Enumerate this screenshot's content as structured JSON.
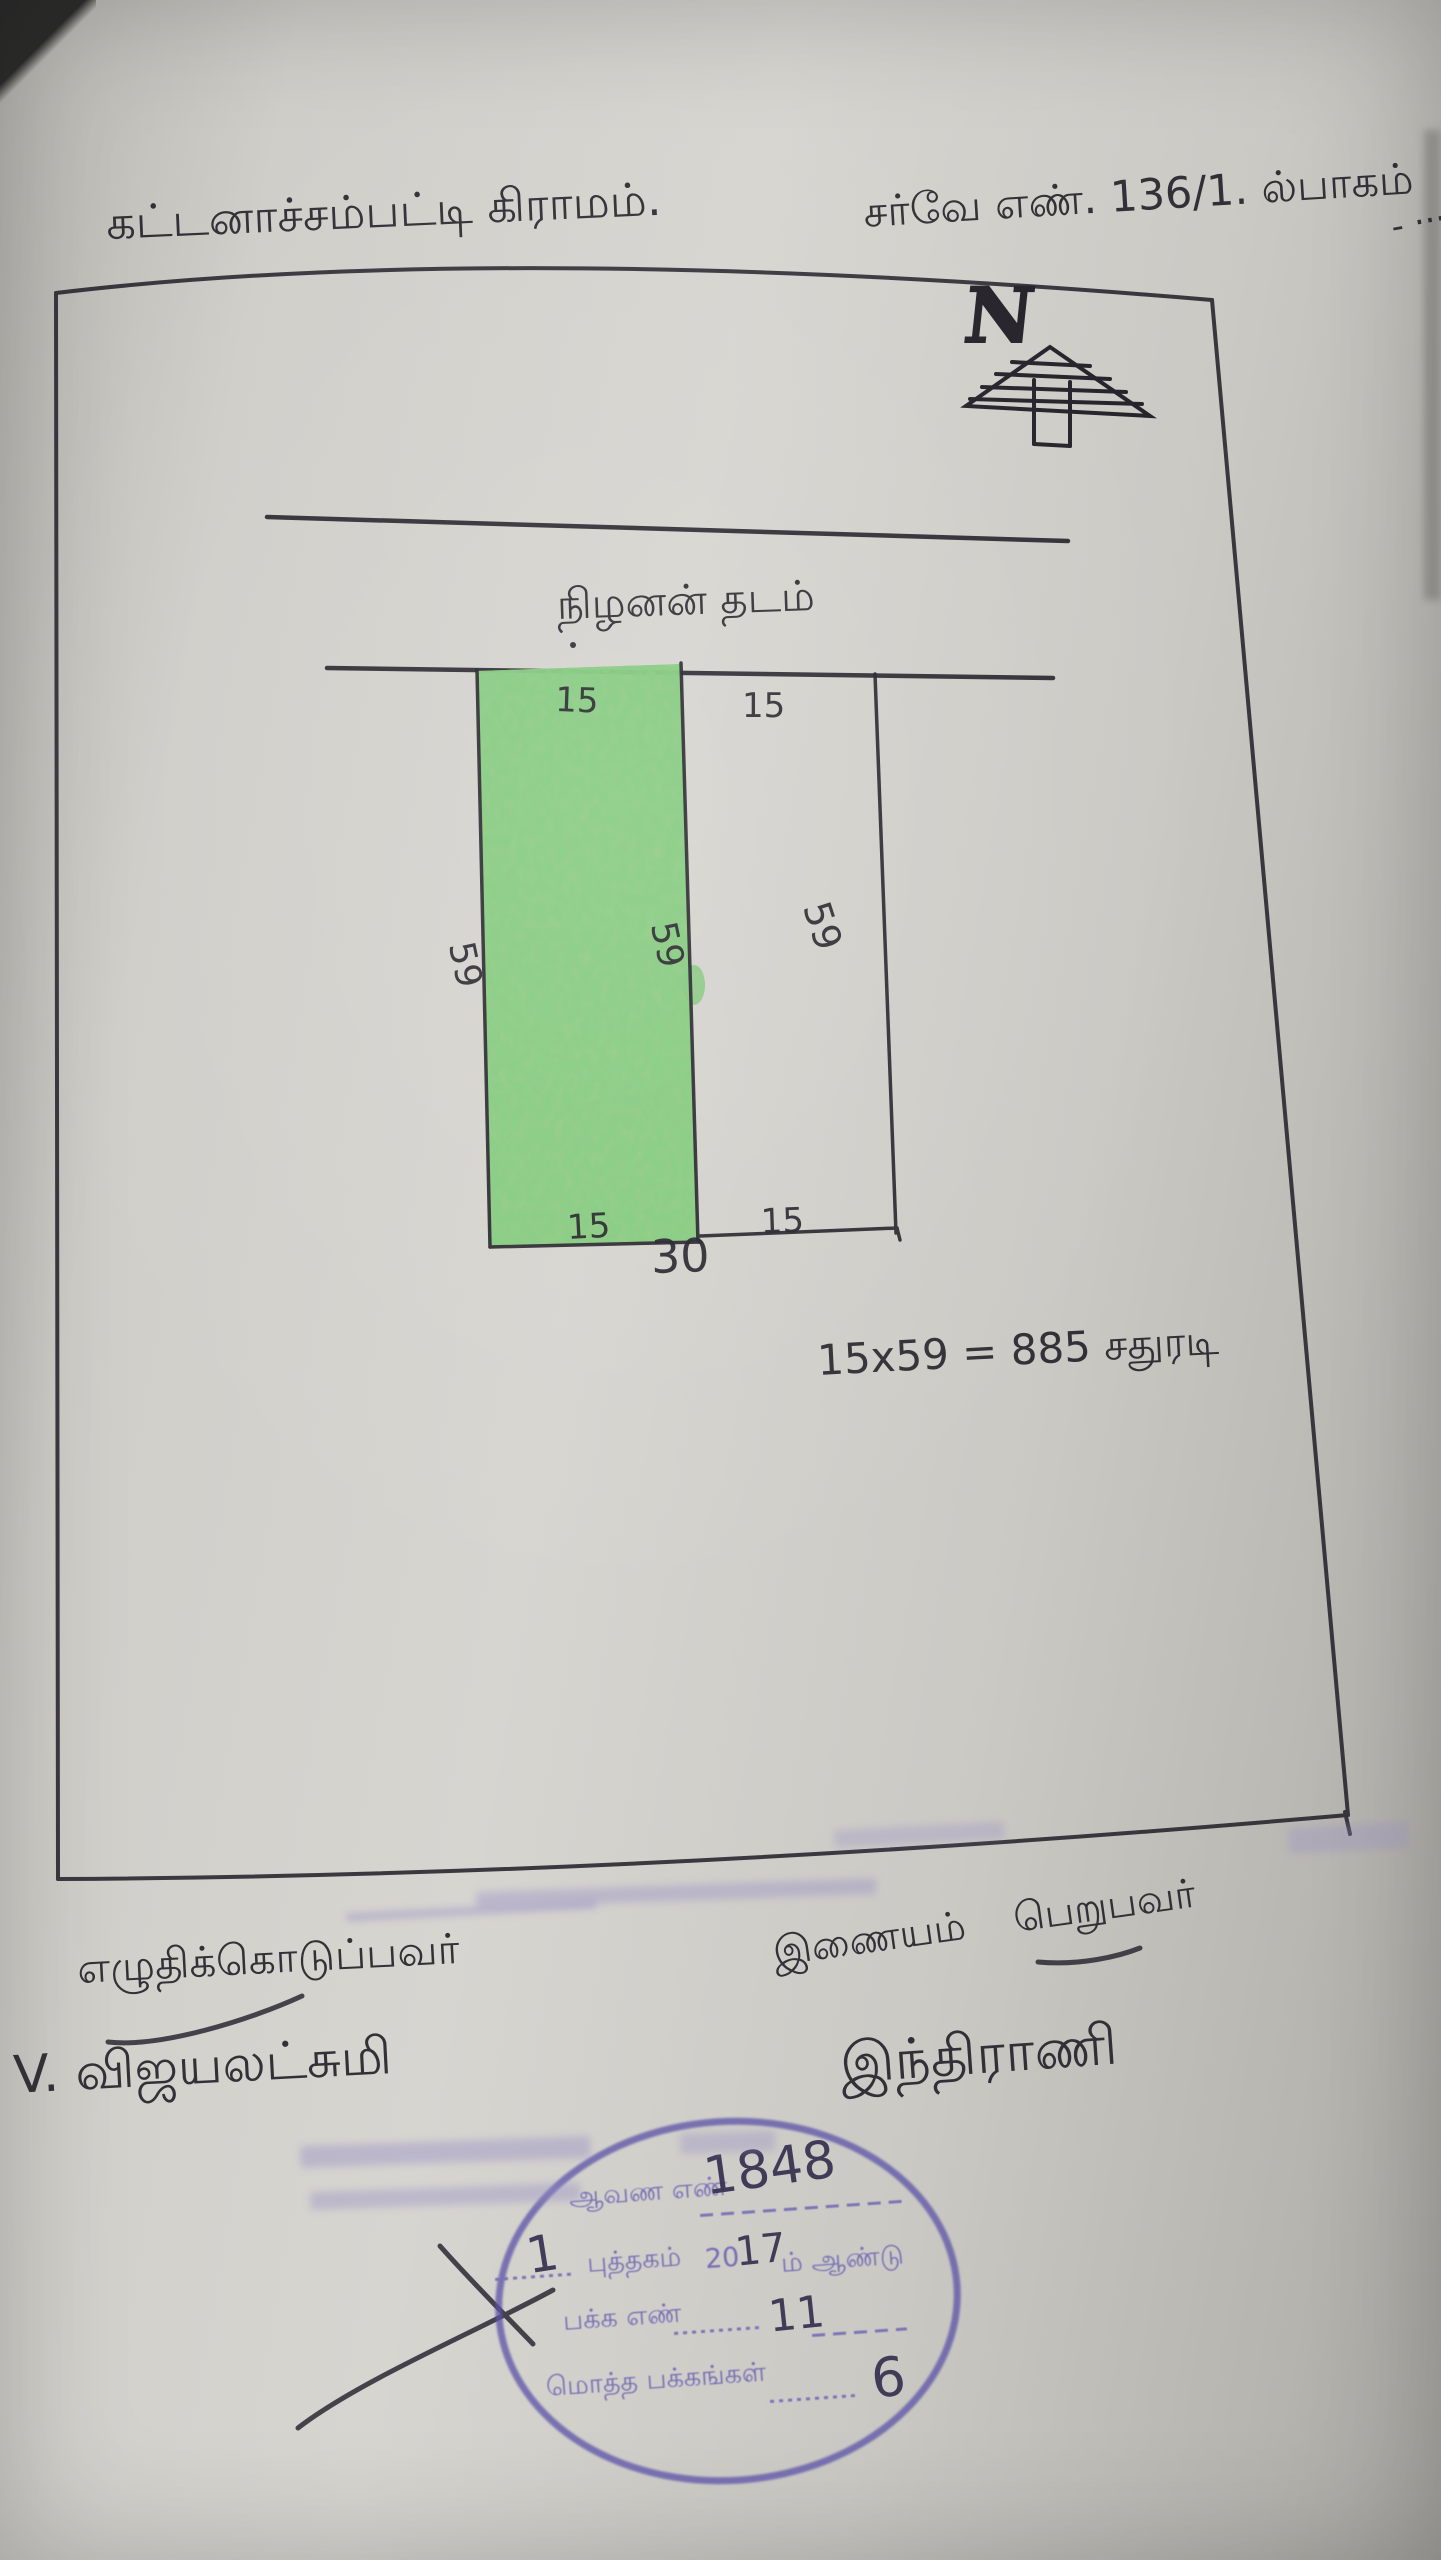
{
  "page": {
    "village_title": "கட்டனாச்சம்பட்டி கிராமம்.",
    "survey_number": "சர்வே எண். 136/1. ல்பாகம்",
    "survey_dashes": "- ···",
    "north_label": "N",
    "road_label": "நிழனன் தடம்"
  },
  "plot": {
    "top_left_width": "15",
    "top_right_width": "15",
    "left_length": "59",
    "middle_length": "59",
    "right_length": "59",
    "bottom_left_width": "15",
    "bottom_right_width": "15",
    "total_width": "30",
    "area_calculation": "15x59 = 885 சதுரடி"
  },
  "signatures": {
    "writer_role": "எழுதிக்கொடுப்பவர்",
    "writer_name": "V. விஜயலட்சுமி",
    "receiver_role": "இணையம் பெறுபவர்",
    "receiver_name": "இந்திராணி"
  },
  "stamp": {
    "document_no_label": "ஆவண எண்",
    "document_no_value": "1848",
    "book_no_value": "1",
    "book_label": "புத்தகம்",
    "year_prefix": "20",
    "year_value": "17",
    "year_suffix": "ம் ஆண்டு",
    "page_no_label": "பக்க எண்",
    "page_no_value": "11",
    "total_pages_label": "மொத்த பக்கங்கள்",
    "total_pages_value": "6"
  },
  "colors": {
    "pen_ink": "#26232b",
    "stamp_purple": "#5a52a8",
    "handwritten_ink": "#3a3453",
    "plot_green": "#7cc36a",
    "paper": "#cbc9c4"
  }
}
